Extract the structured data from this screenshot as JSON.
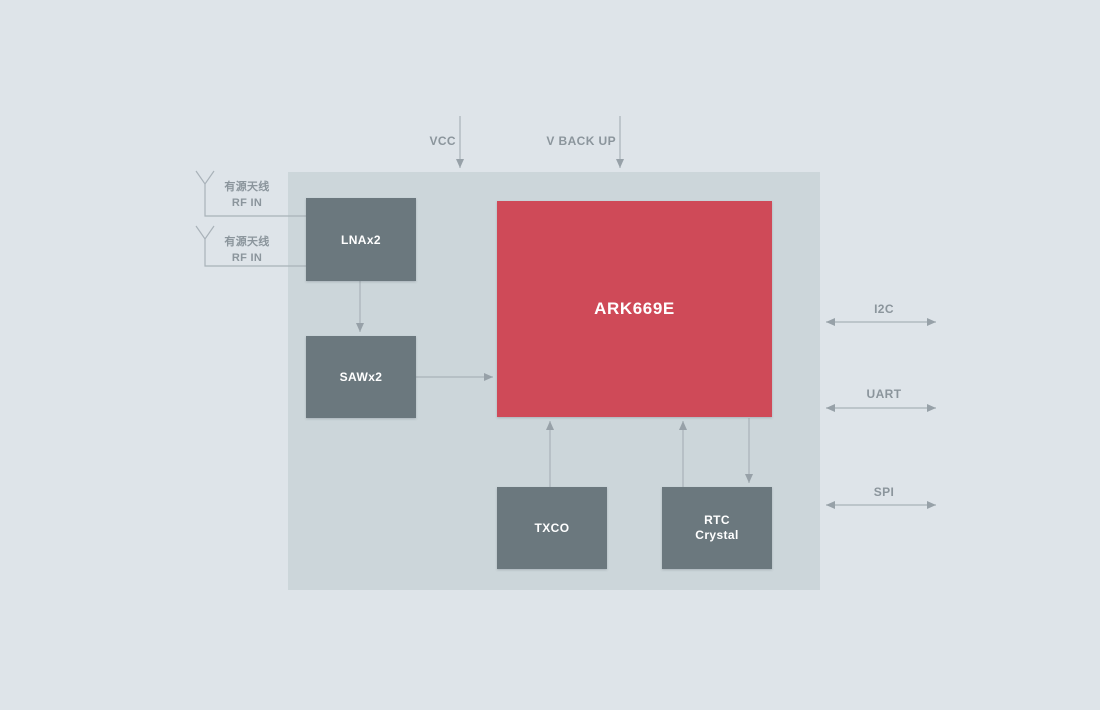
{
  "colors": {
    "page-bg": "#dee4e9",
    "container-bg": "#ccd6da",
    "block-bg": "#6b787e",
    "accent-red": "#cf4a58",
    "label-gray": "#8b959c",
    "line-gray": "#a9b2b9",
    "arrowhead-gray": "#97a1a8",
    "block-text": "#ffffff"
  },
  "diagram": {
    "chip": {
      "label": "ARK669E"
    },
    "blocks": {
      "lna": {
        "label": "LNAx2"
      },
      "saw": {
        "label": "SAWx2"
      },
      "txco": {
        "label": "TXCO"
      },
      "rtc": {
        "label_line1": "RTC",
        "label_line2": "Crystal"
      }
    },
    "power_pins": {
      "vcc": {
        "label": "VCC"
      },
      "vbackup": {
        "label": "V BACK UP"
      }
    },
    "antenna_inputs": [
      {
        "label_line1": "有源天线",
        "label_line2": "RF IN"
      },
      {
        "label_line1": "有源天线",
        "label_line2": "RF IN"
      }
    ],
    "interfaces": {
      "i2c": {
        "label": "I2C"
      },
      "uart": {
        "label": "UART"
      },
      "spi": {
        "label": "SPI"
      }
    }
  }
}
